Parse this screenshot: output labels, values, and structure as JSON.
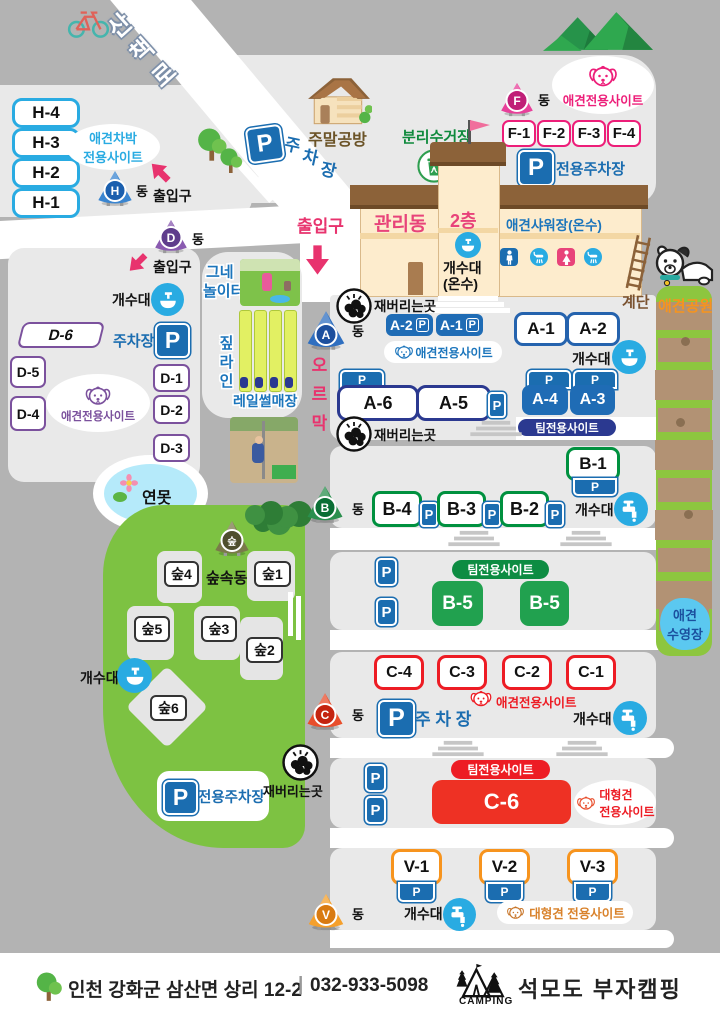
{
  "common": {
    "p": "P",
    "dong": "동",
    "sink": "개수대",
    "ash": "재버리는곳",
    "entrance": "출입구",
    "team": "팀전용사이트",
    "dog_site": "애견전용사이트"
  },
  "road": {
    "walk": "산책로"
  },
  "h_area": {
    "letter": "H",
    "sites": [
      "H-4",
      "H-3",
      "H-2",
      "H-1"
    ],
    "type_line1": "애견차박",
    "type_line2": "전용사이트"
  },
  "top": {
    "workshop": "주말공방",
    "parking_char1": "주",
    "parking_char2": "차",
    "parking_char3": "장",
    "recycle": "분리수거장"
  },
  "f_area": {
    "letter": "F",
    "sites": [
      "F-1",
      "F-2",
      "F-3",
      "F-4"
    ],
    "parking_label": "전용주차장"
  },
  "building": {
    "name": "관리동",
    "floor": "2층",
    "shower": "애견샤워장(온수)",
    "sink_line1": "개수대",
    "sink_line2": "(온수)",
    "stairs_label": "계단"
  },
  "dogpark": {
    "label": "애견공원",
    "pool_line1": "애견",
    "pool_line2": "수영장"
  },
  "a_area": {
    "letter": "A",
    "uphill": "오르막",
    "sites_small": [
      "A-2",
      "A-1"
    ],
    "sites_plain": [
      "A-1",
      "A-2"
    ],
    "a6": "A-6",
    "a5": "A-5",
    "a4": "A-4",
    "a3": "A-3"
  },
  "b_area": {
    "letter": "B",
    "b1": "B-1",
    "sites": [
      "B-4",
      "B-3",
      "B-2"
    ],
    "b5_left": "B-5",
    "b5_right": "B-5"
  },
  "c_area": {
    "letter": "C",
    "sites": [
      "C-4",
      "C-3",
      "C-2",
      "C-1"
    ],
    "parking": "주 차 장",
    "c6": "C-6",
    "large_line1": "대형견",
    "large_line2": "전용사이트"
  },
  "v_area": {
    "letter": "V",
    "sites": [
      "V-1",
      "V-2",
      "V-3"
    ],
    "large": "대형견 전용사이트"
  },
  "d_area": {
    "letter": "D",
    "sites": [
      "D-6",
      "D-5",
      "D-4",
      "D-1",
      "D-2",
      "D-3"
    ],
    "parking": "주차장"
  },
  "play": {
    "swing_line1": "그네",
    "swing_line2": "놀이터",
    "zip": "짚라인",
    "rail": "레일썰매장"
  },
  "pond": {
    "label": "연못"
  },
  "forest": {
    "letter": "숲",
    "dong_name": "숲속동",
    "sites": [
      "숲4",
      "숲1",
      "숲5",
      "숲3",
      "숲2",
      "숲6"
    ],
    "parking": "전용주차장"
  },
  "footer": {
    "address": "인천 강화군 삼산면 상리 12-2",
    "divider": "|",
    "phone": "032-933-5098",
    "camping": "CAMPING",
    "name": "석모도 부자캠핑"
  },
  "colors": {
    "pink": "#e8336e",
    "blue": "#1b6db0",
    "cyan": "#29abe2",
    "green": "#00913f",
    "red": "#ed1c24",
    "orange": "#f7941e",
    "purple": "#7b519d",
    "navy": "#2b3990",
    "grass": "#7dc242",
    "park_green": "#8dc63f"
  }
}
